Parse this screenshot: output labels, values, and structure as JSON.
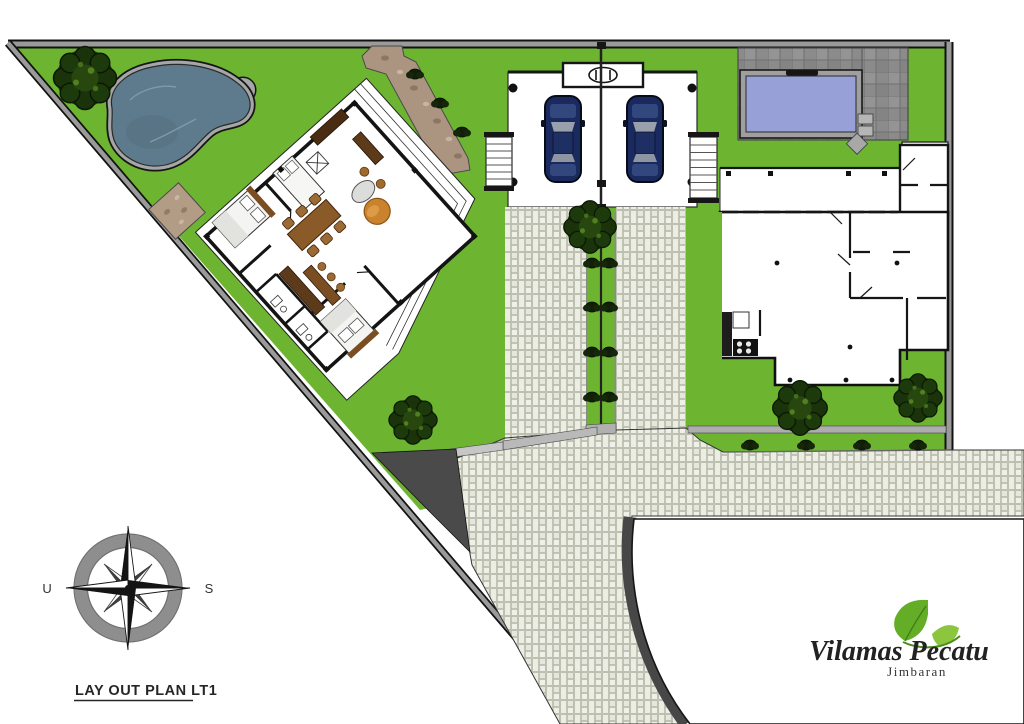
{
  "site_plan": {
    "title": "LAY OUT PLAN LT1",
    "compass": {
      "west_label": "U",
      "east_label": "S"
    },
    "brand": {
      "name": "Vilamas Pecatu",
      "subtitle": "Jimbaran"
    },
    "colors": {
      "grass": "#6db531",
      "paving": "#dadcd0",
      "main_pool_water": "#5d7b8d",
      "plunge_pool_water": "#98a0d8",
      "stone_deck": "#8b8b8b",
      "stone_path": "#ab9480",
      "car_body": "#1a2a5e",
      "dark_curb": "#4a4a4a",
      "leaf": "#64ad26",
      "text": "#262626"
    }
  }
}
